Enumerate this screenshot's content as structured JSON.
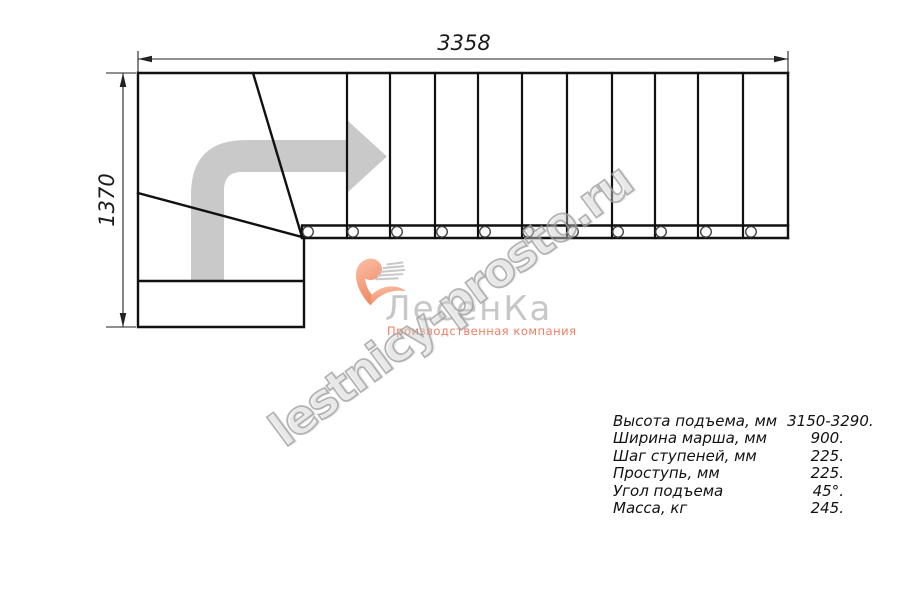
{
  "drawing": {
    "top_dimension": "3358",
    "left_dimension": "1370"
  },
  "watermark": {
    "text": "lestnicy-prosto.ru"
  },
  "logo": {
    "name": "ЛесенКа",
    "tagline": "Производственная компания"
  },
  "specs": {
    "rows": [
      {
        "label": "Высота подъема, мм",
        "value": "3150-3290."
      },
      {
        "label": "Ширина марша, мм",
        "value": "900."
      },
      {
        "label": "Шаг ступеней, мм",
        "value": "225."
      },
      {
        "label": "Проступь, мм",
        "value": "225."
      },
      {
        "label": "Угол подъема",
        "value": "45°."
      },
      {
        "label": "Масса, кг",
        "value": "245."
      }
    ]
  },
  "colors": {
    "line": "#111111",
    "dimension_line": "#222222",
    "direction_arrow": "#c9c9c9",
    "watermark_gray": "#9e9e9e",
    "logo_gray": "#c7c7c7",
    "brand_salmon": "#ee7e61"
  }
}
